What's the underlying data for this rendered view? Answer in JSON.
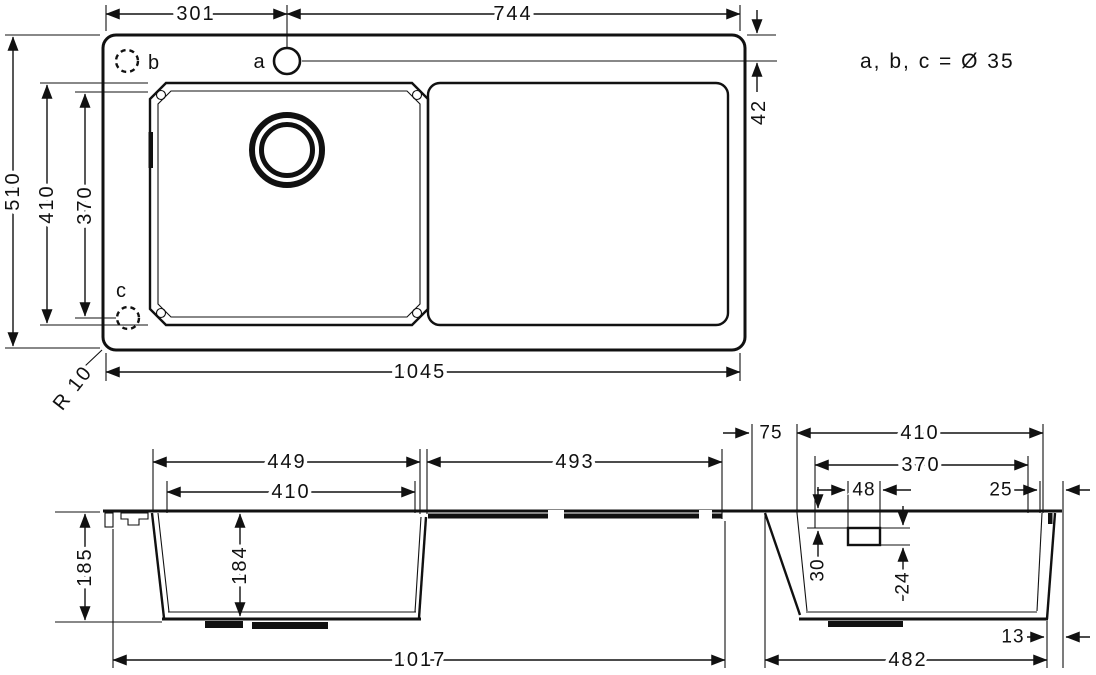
{
  "drawing": {
    "note": "a, b, c = Ø 35",
    "radius_label": "R 10",
    "top_view": {
      "hole_a_label": "a",
      "hole_b_label": "b",
      "hole_c_label": "c",
      "dist_left_to_hole_a": "301",
      "dist_hole_a_to_right": "744",
      "hole_a_offset_from_top": "42",
      "depth_total": "510",
      "bowl_depth_outer": "410",
      "bowl_depth_inner": "370",
      "length_total": "1045",
      "corner_radius": "R 10"
    },
    "side_view": {
      "bowl_length_outer": "449",
      "bowl_length_inner": "410",
      "drainer_length": "493",
      "height_total": "185",
      "bowl_depth": "184",
      "length_underside": "1017"
    },
    "end_view": {
      "rim_left": "75",
      "bowl_width_outer": "410",
      "bowl_width_inner": "370",
      "clip_width": "48",
      "rim_right": "25",
      "clip_offset_top": "30",
      "clip_height": "24",
      "edge_thickness": "13",
      "width_underside": "482"
    }
  }
}
